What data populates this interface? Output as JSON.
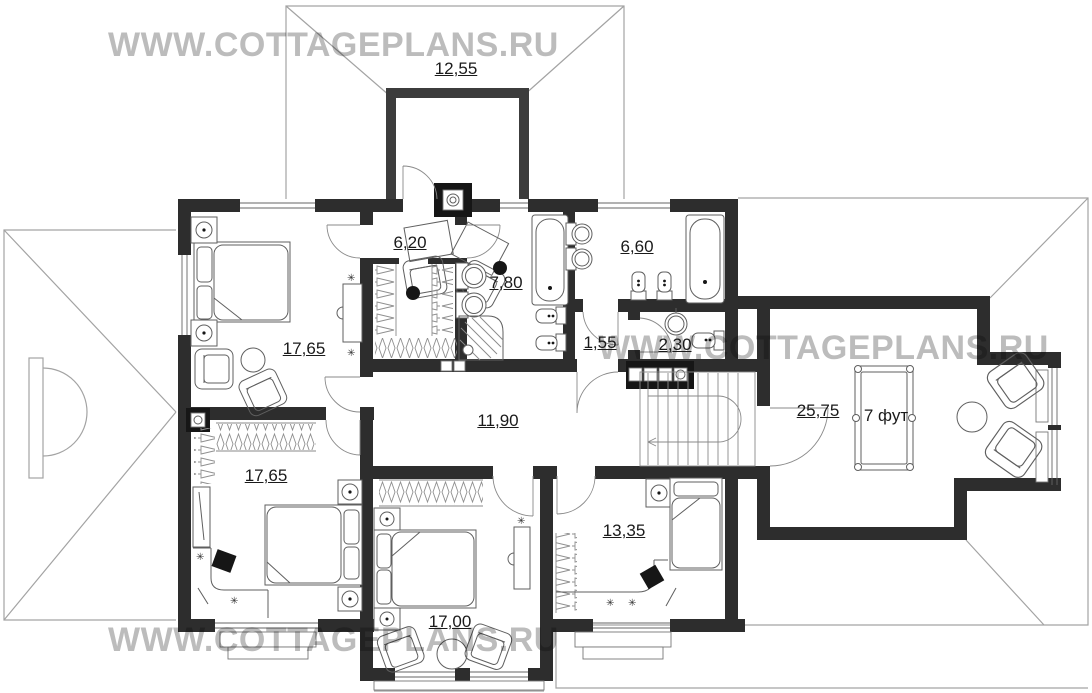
{
  "watermarks": [
    {
      "text": "WWW.COTTAGEPLANS.RU"
    },
    {
      "text": "WWW.COTTAGEPLANS.RU"
    },
    {
      "text": "WWW.COTTAGEPLANS.RU"
    }
  ],
  "room_labels": [
    {
      "room": "balcony",
      "area": "12,55"
    },
    {
      "room": "bedroom-top-left",
      "area": "17,65"
    },
    {
      "room": "vestibule",
      "area": "6,20"
    },
    {
      "room": "bathroom-main",
      "area": "7,80"
    },
    {
      "room": "bathroom-second",
      "area": "6,60"
    },
    {
      "room": "hallway-small",
      "area": "1,55"
    },
    {
      "room": "wc",
      "area": "2,30"
    },
    {
      "room": "hall",
      "area": "11,90"
    },
    {
      "room": "billiard-room",
      "area": "25,75"
    },
    {
      "room": "bedroom-bottom-left",
      "area": "17,65"
    },
    {
      "room": "bedroom-bottom-middle",
      "area": "17,00"
    },
    {
      "room": "bedroom-bottom-right",
      "area": "13,35"
    }
  ],
  "billiard_table_label": "7 фут",
  "colors": {
    "wall": "#2d2d2d",
    "balcony_wall": "#3c3c3c",
    "roof_line": "#a3a3a3",
    "watermark": "#bcbcbc",
    "label_text": "#1a1a1a"
  }
}
